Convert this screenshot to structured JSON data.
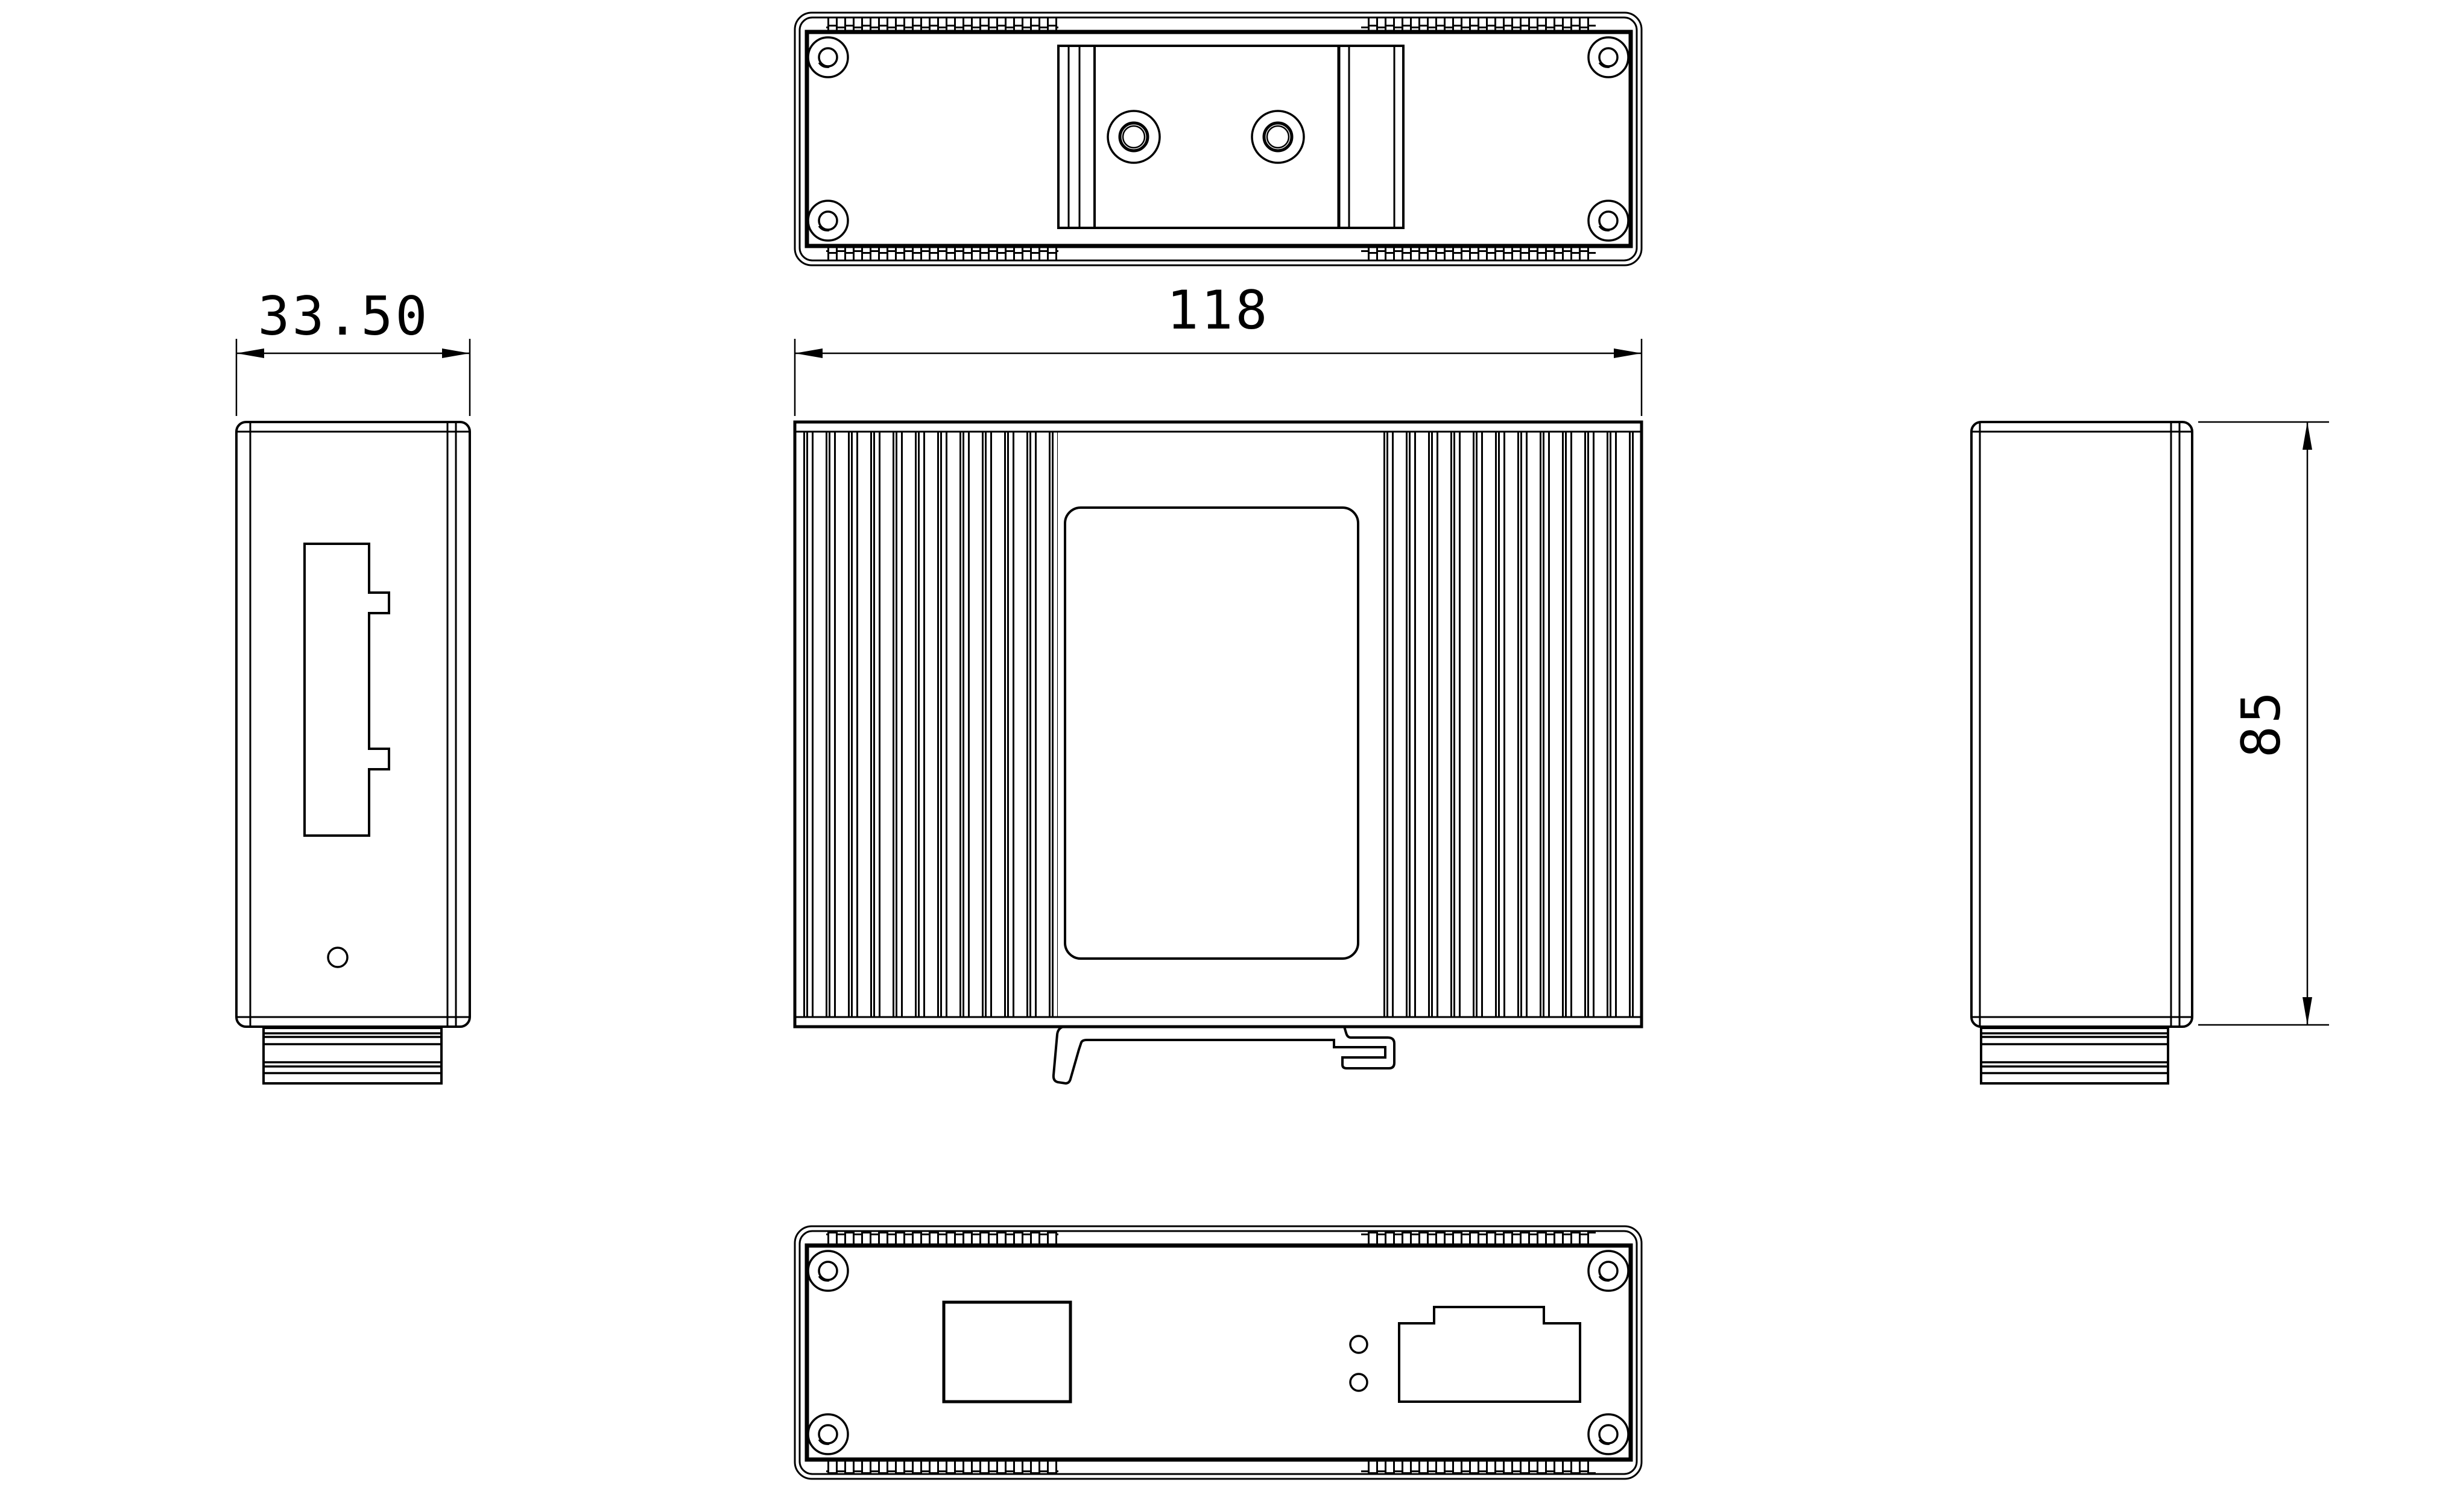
{
  "colors": {
    "line": "#000000",
    "background": "#ffffff"
  },
  "dimensions": {
    "left_view_width": "33.50",
    "front_view_width": "118",
    "side_height": "85"
  }
}
